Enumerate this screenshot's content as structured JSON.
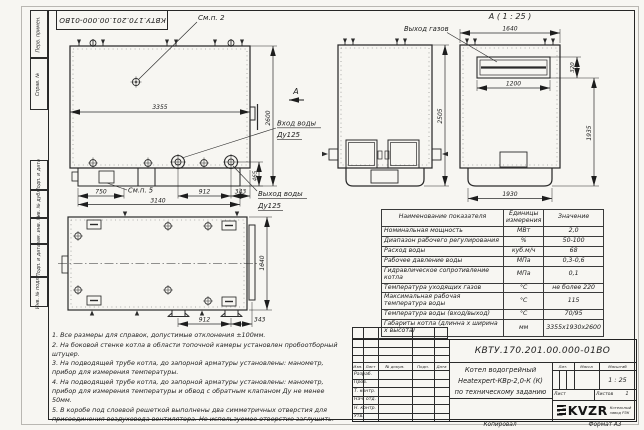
{
  "frame": {
    "top_stamp": "КВТУ.170.201.00.000-01ВО",
    "margin_labels": [
      "Перв. примен.",
      "Справ. №",
      "Подп. и дата",
      "Инв. № дубл.",
      "Взам. инв. №",
      "Подп. и дата",
      "Инв. № подл."
    ],
    "footer_copy": "Копировал",
    "footer_format": "Формат А3"
  },
  "drawing": {
    "side_view": {
      "callout_top": "См.п. 2",
      "callout_base": "См.п. 5",
      "dim_length": "3355",
      "dim_height": "2600",
      "dim_left_base": "750",
      "dim_base_total": "3140",
      "dim_flanges": "912",
      "dim_outlet_edge": "343",
      "dim_outlet_height": "465",
      "section_arrow": "А",
      "water_in_1": "Вход воды",
      "water_in_2": "Ду125",
      "water_out_1": "Выход воды",
      "water_out_2": "Ду125"
    },
    "front_view": {
      "dim_height": "2505"
    },
    "rear_view": {
      "title": "А ( 1 : 25 )",
      "gas_out": "Выход газов",
      "dim_width": "1640",
      "dim_opening_width": "1200",
      "dim_opening_height": "320",
      "dim_height": "1935",
      "dim_base_width": "1930"
    },
    "plan_view": {
      "dim_width": "1640",
      "dim_supports": "912",
      "dim_edge": "343"
    }
  },
  "spec_table": {
    "headers": [
      "Наименование показателя",
      "Единицы измерения",
      "Значение"
    ],
    "rows": [
      [
        "Номинальная мощность",
        "МВт",
        "2,0"
      ],
      [
        "Диапазон рабочего регулирования",
        "%",
        "50-100"
      ],
      [
        "Расход воды",
        "куб.м/ч",
        "68"
      ],
      [
        "Рабочее давление воды",
        "МПа",
        "0,3-0,6"
      ],
      [
        "Гидравлическое сопротивление котла",
        "МПа",
        "0,1"
      ],
      [
        "Температура уходящих газов",
        "°С",
        "не более 220"
      ],
      [
        "Максимальная рабочая температура воды",
        "°С",
        "115"
      ],
      [
        "Температура воды (вход/выход)",
        "°С",
        "70/95"
      ],
      [
        "Габариты котла (длинна х ширина х высота)",
        "мм",
        "3355х1930х2600"
      ]
    ]
  },
  "notes": [
    "1. Все размеры для справок, допустимые отклонения ±100мм.",
    "2. На боковой стенке котла в области топочной камеры установлен пробоотборный штуцер.",
    "3. На подводящей трубе котла, до запорной арматуры установлены: манометр, прибор для измерения температуры.",
    "4. На подводящей трубе котла, до запорной арматуры установлены: манометр, прибор для измерения температуры и обвод с обратным клапаном Ду не менее 50мм.",
    "5. В коробе под слоевой решеткой выполнены два симметричных отверстия для присоединения воздуховода вентилятора. Не используемое отверстие заглушить."
  ],
  "title_block": {
    "doc_number": "КВТУ.170.201.00.000-01ВО",
    "product_line1": "Котел водогрейный",
    "product_line2": "Heatexpert-КВр-2,0-К (К)",
    "product_line3": "по техническому заданию",
    "cols": [
      "Изм.",
      "Лист",
      "№ докум.",
      "Подп.",
      "Дата"
    ],
    "roles": [
      "Разраб.",
      "Пров.",
      "Т. контр.",
      "Нач. отд.",
      "Н. контр.",
      "Утв."
    ],
    "lit": "Лит.",
    "mass": "Масса",
    "scale": "Масштаб",
    "scale_value": "1 : 25",
    "sheet": "Лист",
    "sheets": "Листов",
    "sheets_value": "1",
    "logo": "KVZR",
    "logo_caption_1": "Котельный",
    "logo_caption_2": "завод РЗК"
  }
}
